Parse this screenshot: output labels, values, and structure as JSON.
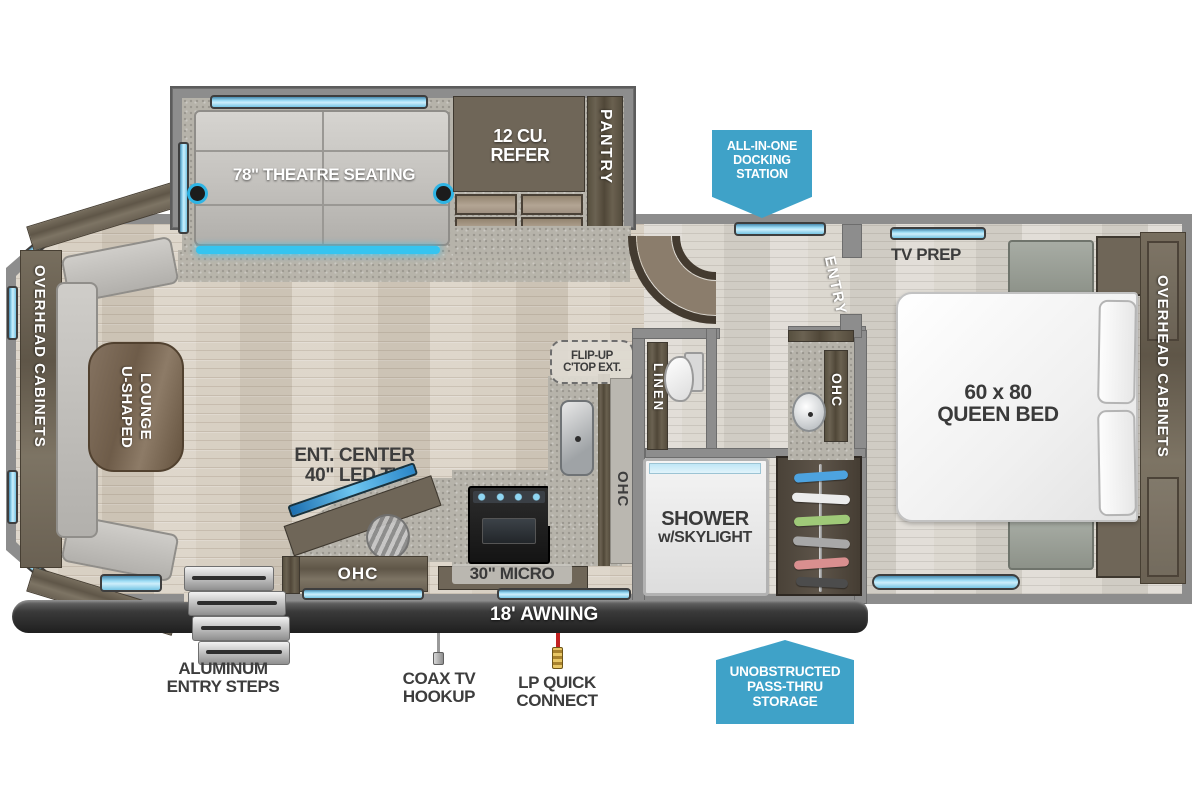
{
  "labels": {
    "theatre": "78\" THEATRE SEATING",
    "refer": "12 CU. REFER",
    "pantry": "PANTRY",
    "overhead_left": "OVERHEAD CABINETS",
    "lounge_l1": "U-SHAPED",
    "lounge_l2": "LOUNGE",
    "ent_l1": "ENT. CENTER",
    "ent_l2": "40\" LED TV",
    "ohc_bottom": "OHC",
    "micro": "30\" MICRO",
    "flip_l1": "FLIP-UP",
    "flip_l2": "C'TOP EXT.",
    "ohc_kitchen": "OHC",
    "linen": "LINEN",
    "ohc_vanity": "OHC",
    "shower_l1": "SHOWER",
    "shower_l2": "w/SKYLIGHT",
    "entry": "ENTRY",
    "tv_prep": "TV PREP",
    "bed_l1": "60 x 80",
    "bed_l2": "QUEEN BED",
    "overhead_right": "OVERHEAD CABINETS",
    "awning": "18' AWNING",
    "steps": "ALUMINUM ENTRY STEPS",
    "coax": "COAX TV HOOKUP",
    "lp": "LP QUICK CONNECT"
  },
  "callouts": {
    "docking": [
      "ALL-IN-ONE",
      "DOCKING",
      "STATION"
    ],
    "pass_thru": [
      "UNOBSTRUCTED",
      "PASS-THRU",
      "STORAGE"
    ]
  },
  "colors": {
    "callout_blue": "#3FA2C8",
    "window_blue": "#8FD3EE",
    "accent_teal": "#35C4F0"
  }
}
